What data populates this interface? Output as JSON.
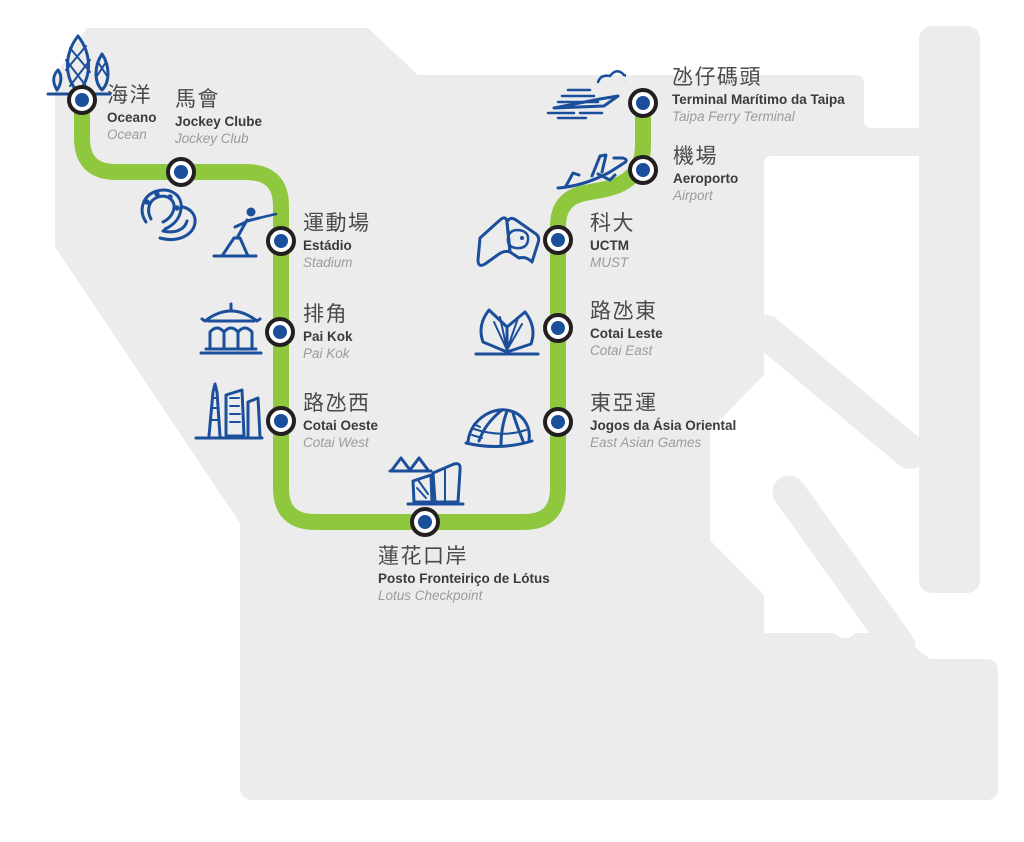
{
  "map": {
    "region_name": "Taipa / Cotai",
    "line_color": "#8FC83E",
    "land_color": "#ECECEC",
    "station_dot_color": "#1B4F9C",
    "station_ring_color": "#231F20"
  },
  "stations": [
    {
      "id": "oceano",
      "zh": "海洋",
      "pt": "Oceano",
      "en": "Ocean",
      "icon": "lotus-towers-icon"
    },
    {
      "id": "jockey-club",
      "zh": "馬會",
      "pt": "Jockey Clube",
      "en": "Jockey Club",
      "icon": "horseshoe-icon"
    },
    {
      "id": "estadio",
      "zh": "運動場",
      "pt": "Estádio",
      "en": "Stadium",
      "icon": "fencer-icon"
    },
    {
      "id": "pai-kok",
      "zh": "排角",
      "pt": "Pai Kok",
      "en": "Pai Kok",
      "icon": "pavilion-icon"
    },
    {
      "id": "cotai-oeste",
      "zh": "路氹西",
      "pt": "Cotai Oeste",
      "en": "Cotai West",
      "icon": "towers-icon"
    },
    {
      "id": "lotus",
      "zh": "蓮花口岸",
      "pt": "Posto Fronteiriço de Lótus",
      "en": "Lotus Checkpoint",
      "icon": "checkpoint-building-icon"
    },
    {
      "id": "east-asian-games",
      "zh": "東亞運",
      "pt": "Jogos da Ásia Oriental",
      "en": "East Asian Games",
      "icon": "dome-icon"
    },
    {
      "id": "cotai-leste",
      "zh": "路氹東",
      "pt": "Cotai Leste",
      "en": "Cotai East",
      "icon": "book-building-icon"
    },
    {
      "id": "uctm",
      "zh": "科大",
      "pt": "UCTM",
      "en": "MUST",
      "icon": "book-logo-icon"
    },
    {
      "id": "aeroporto",
      "zh": "機場",
      "pt": "Aeroporto",
      "en": "Airport",
      "icon": "airplane-icon"
    },
    {
      "id": "taipa-ferry",
      "zh": "氹仔碼頭",
      "pt": "Terminal Marítimo da Taipa",
      "en": "Taipa Ferry Terminal",
      "icon": "ferry-icon"
    }
  ]
}
